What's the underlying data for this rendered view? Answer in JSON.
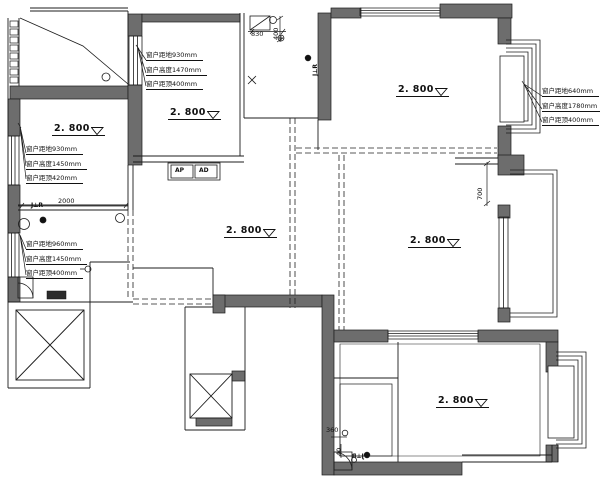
{
  "levels": [
    {
      "label": "2. 800"
    },
    {
      "label": "2. 800"
    },
    {
      "label": "2. 800"
    },
    {
      "label": "2. 800"
    },
    {
      "label": "2. 800"
    },
    {
      "label": "2. 800"
    }
  ],
  "window_annotations": [
    {
      "lines": [
        "窗户距地930mm",
        "窗户高度1470mm",
        "窗户距顶400mm"
      ]
    },
    {
      "lines": [
        "窗户距地930mm",
        "窗户高度1450mm",
        "窗户距顶420mm"
      ]
    },
    {
      "lines": [
        "窗户距地960mm",
        "窗户高度1450mm",
        "窗户距顶400mm"
      ]
    },
    {
      "lines": [
        "窗户距地640mm",
        "窗户高度1780mm",
        "窗户距顶400mm"
      ]
    }
  ],
  "dimensions": {
    "d2000": "2000",
    "d830": "830",
    "d400": "400",
    "d700": "700",
    "d360": "360",
    "d40": "40"
  },
  "labels": {
    "switch": "J⊥R",
    "panel_ap": "AP",
    "panel_ad": "AD"
  },
  "colors": {
    "wall": "#6d6d6d",
    "line": "#1c1c1c",
    "background": "#ffffff"
  }
}
